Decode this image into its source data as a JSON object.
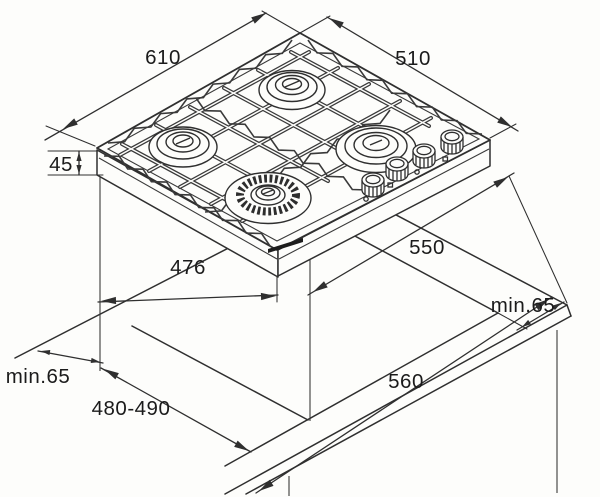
{
  "diagram": {
    "subject": "built-in gas hob installation drawing with worktop cutout",
    "dims": {
      "hob_width": "610",
      "hob_depth": "510",
      "hob_height": "45",
      "body_width": "476",
      "body_depth": "550",
      "cutout_width": "560",
      "cutout_depth": "480-490",
      "clearance_right": "min.65",
      "clearance_left": "min.65"
    },
    "colors": {
      "line": "#2f2f2f",
      "label": "#1b1b1b",
      "background": "#fdfdfb",
      "burner_ring": "#2e2e2e"
    }
  }
}
